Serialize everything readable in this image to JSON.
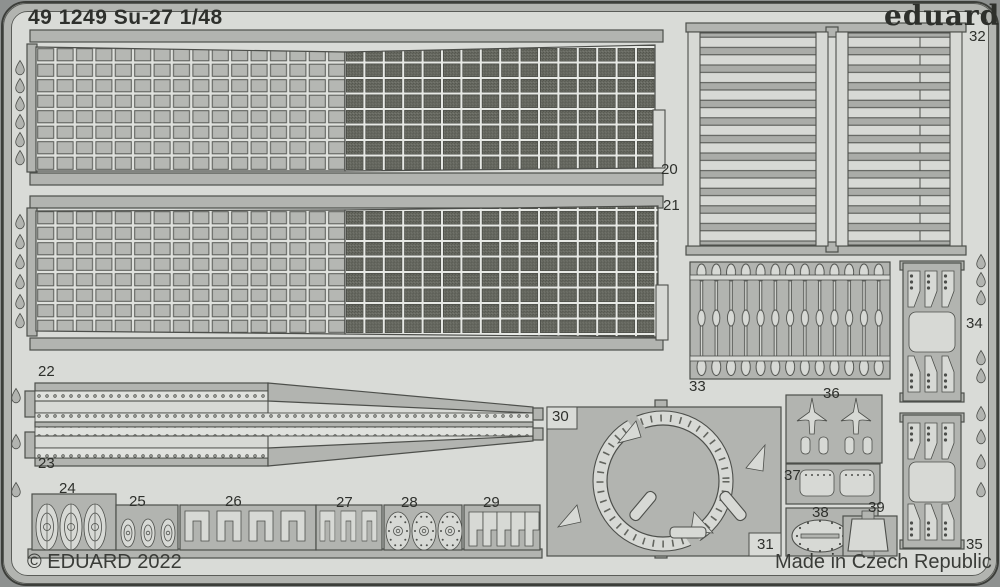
{
  "header": {
    "title": "49 1249 Su-27 1/48",
    "brand": "eduard"
  },
  "footer": {
    "copyright": "© EDUARD 2022",
    "made_in": "Made in Czech Republic"
  },
  "part_numbers": {
    "p20": "20",
    "p21": "21",
    "p22": "22",
    "p23": "23",
    "p24": "24",
    "p25": "25",
    "p26": "26",
    "p27": "27",
    "p28": "28",
    "p29": "29",
    "p30": "30",
    "p31": "31",
    "p32": "32",
    "p33": "33",
    "p34": "34",
    "p35": "35",
    "p36": "36",
    "p37": "37",
    "p38": "38",
    "p39": "39"
  },
  "colors": {
    "background": "#8e9190",
    "sheet": "#d9dbd7",
    "part": "#b2b4b0",
    "part_light": "#d7d9d5",
    "outline": "#4d4f4b",
    "mesh": "#66685f",
    "text": "#2e302c"
  }
}
